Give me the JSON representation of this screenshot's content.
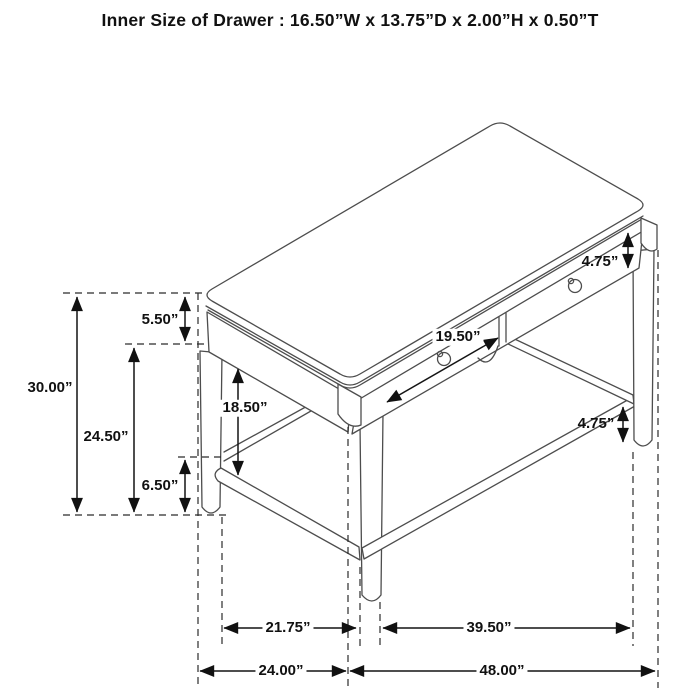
{
  "title": "Inner Size of Drawer : 16.50”W x 13.75”D x 2.00”H x 0.50”T",
  "diagram": {
    "description": "Isometric line drawing of a two-drawer writing desk with round legs and stretchers, annotated with dimensions",
    "unit": "inches",
    "dimensions": {
      "overall_height": "30.00”",
      "top_and_apron_height": "5.50”",
      "apron_bottom_to_floor": "24.50”",
      "left_stretcher_height": "6.50”",
      "apron_to_stretcher_gap": "18.50”",
      "drawer_front_width": "19.50”",
      "drawer_front_height": "4.75”",
      "right_stretcher_height": "4.75”",
      "inner_leg_depth": "21.75”",
      "overall_depth": "24.00”",
      "inner_leg_width": "39.50”",
      "overall_width": "48.00”"
    }
  }
}
